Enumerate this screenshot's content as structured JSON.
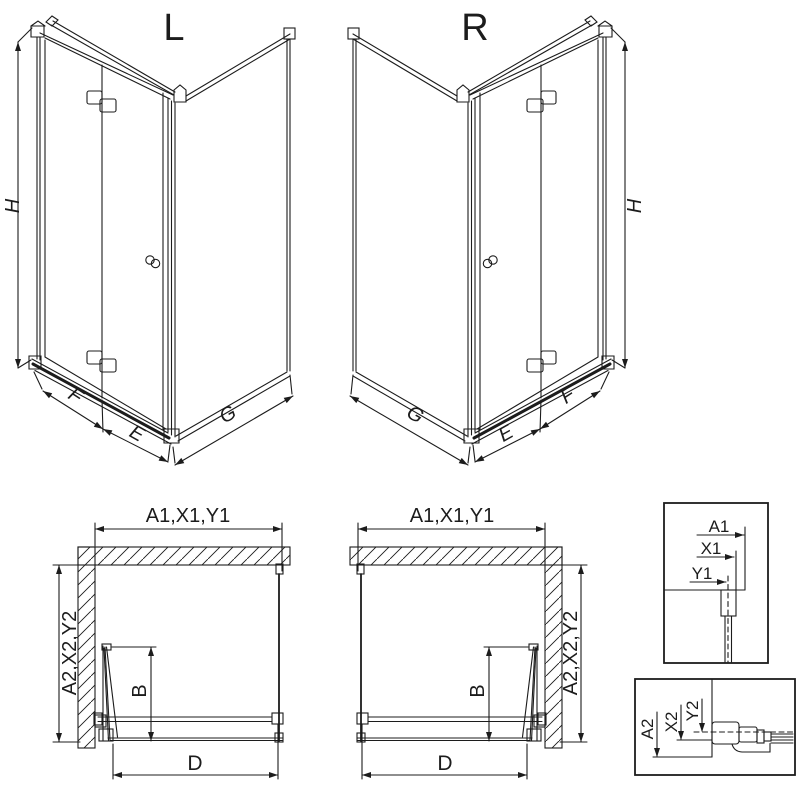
{
  "page": {
    "background": "#ffffff",
    "line_color": "#1c1c1c"
  },
  "views": {
    "iso_left": {
      "label": "L",
      "dim_height": "H",
      "dim_panel_f": "F",
      "dim_panel_e": "E",
      "dim_side_g": "G"
    },
    "iso_right": {
      "label": "R",
      "dim_height": "H",
      "dim_panel_f": "F",
      "dim_panel_e": "E",
      "dim_side_g": "G"
    },
    "plan_left": {
      "dim_width": "A1,X1,Y1",
      "dim_depth": "A2,X2,Y2",
      "dim_door": "B",
      "dim_entry": "D"
    },
    "plan_right": {
      "dim_width": "A1,X1,Y1",
      "dim_depth": "A2,X2,Y2",
      "dim_door": "B",
      "dim_entry": "D"
    },
    "detail_wall_profile": {
      "dim_a": "A1",
      "dim_x": "X1",
      "dim_y": "Y1"
    },
    "detail_floor_profile": {
      "dim_a": "A2",
      "dim_x": "X2",
      "dim_y": "Y2"
    }
  }
}
